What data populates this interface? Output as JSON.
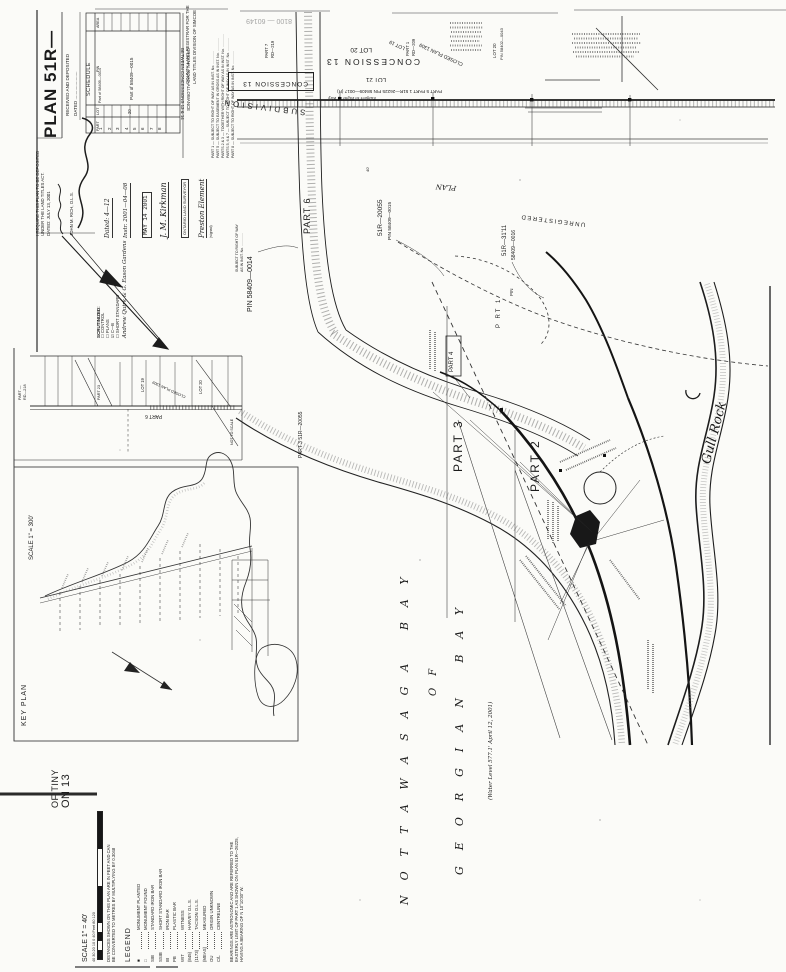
{
  "title_block": {
    "plan_no": "PLAN 51R—",
    "received": "RECEIVED AND DEPOSITED",
    "dated_blank": "DATED ......................",
    "registrar1": "COUNTY LAND REGISTRAR FOR THE",
    "registrar2": "LAND TITLES DIVISION OF SIMCOE",
    "stamp_no": "8100 — 60149",
    "require1": "I REQUIRE THIS PLAN TO BE DEPOSITED",
    "require2": "UNDER THE LAND TITLES ACT.",
    "require_dated": "DATED: JULY 13, 2001",
    "require_signed": "JOHN M. RICH,  O.L.S."
  },
  "schedule": {
    "title": "SCHEDULE",
    "col_part": "PART",
    "col_lot": "LOT",
    "col_pin": "PIN",
    "col_area": "AREA",
    "rows": [
      "1",
      "2",
      "3",
      "4",
      "5",
      "6",
      "7",
      "8"
    ],
    "pin_row1": "Part of 58409—0014",
    "pin_merged": "Part of 58409—0015",
    "lot_value": "20"
  },
  "notes": {
    "n1": "PART 1 — SUBJECT TO RIGHT OF WAY AS IN INST. No. .............",
    "n2": "PART 5 — SUBJECT TO EASEMENT IN GROSS AS IN INST. No. .............",
    "n3": "PARTS 2 & 3 — TOGETHER WITH RIGHT OF WAY AS IN INST. No. .............",
    "n4": "PARTS 5, 6 & 7 — SUBJECT TO RIGHT OF WAY AS IN INST. No. .............",
    "n5": "PART 8 — SUBJECT TO RIGHT OF WAY AS IN INST. No. ............."
  },
  "certificate": {
    "dated_hand": "Dated: 4—12",
    "instr_hand": "Instr. 2001—04—08",
    "date_stamp": "MAY 14 2001",
    "sig1": "J. M. Kirkman",
    "role_box": "ONTARIO LAND SURVEYOR",
    "sig2": "Preston Element",
    "signed_note": "(signed)",
    "firm": "Andrew Quirk & G. Eason Gardens"
  },
  "checklist": {
    "title": "SCRUTINIZED:",
    "i1": "☐ CONTROL",
    "i2": "☐ PLANS",
    "i3": "☑ C—B",
    "i4": "☐ SHORT STANDARD"
  },
  "road": {
    "allowance1": "ORIGINAL ROAD ALLOWANCE",
    "allowance2": "BETWEEN CONCESSIONS 13 & 14",
    "concession_a": "CONCESSION 13",
    "concession_b": "CONCESSION 13",
    "strip_note": "PART 5    PART 1  51R—26225   PIN 58409—0017 (R)",
    "strip_note2": "Subject to Right of Way",
    "subdivision": "SUBDIVISION"
  },
  "lots": {
    "lot20": "LOT 20",
    "lot21": "LOT 21",
    "lot19": "LOT 19",
    "lot20b": "LOT 20",
    "pin58402": "PIN 58402—0043",
    "part1": "PART 1",
    "rd209": "RD—209",
    "part7": "PART 7",
    "rd219": "RD—219",
    "closed_plan": "CLOSED PLAN 1309"
  },
  "parts": {
    "part6": "PART 6",
    "pin0014": "PIN  58409—0014",
    "row1": "SUBJECT TO RIGHT OF WAY",
    "row2": "AS IN INST. No. .............",
    "part3_51r": "PART 3  51R—20055",
    "r20055": "51R—20055",
    "pin0015": "PIN 58409—0015",
    "plan_word": "PLAN",
    "unregistered": "UNREGISTERED",
    "r3111": "51R—31'11",
    "pin0016": "58409—0016",
    "part1v": "P RT 1",
    "pin_word": "PIN",
    "part4": "PART 4",
    "part3": "PART 3",
    "part2": "PART 2",
    "width40": "40'"
  },
  "water": {
    "bay1": "NOTTAWASAGA  BAY",
    "of_word": "OF",
    "bay2": "GEORGIAN  BAY",
    "level": "(Water Level 577.1'  April 12, 2001)",
    "gull_rock": "Gull Rock"
  },
  "strip_inset": {
    "l1": "PART —",
    "l2": "RD—218",
    "part23": "PART 23",
    "lot19": "LOT 19",
    "closed": "CLOSED PLAN 1309",
    "lot20": "LOT 20",
    "part6": "PART 6",
    "nts": "NOT TO SCALE"
  },
  "key_plan": {
    "title": "KEY PLAN",
    "scale": "SCALE  1\" = 300'"
  },
  "sheet_title": {
    "line1": "OF TINY",
    "line2": "ON 13"
  },
  "scale_block": {
    "scale": "SCALE   1\" = 40'",
    "bar_numbers": "40   30   20   10    0              40 Feet               80              120",
    "note1": "DISTANCES SHOWN ON THIS PLAN ARE IN FEET AND CAN",
    "note2": "BE CONVERTED TO METRES BY MULTIPLYING BY 0.3048",
    "legend_title": "LEGEND",
    "items": [
      {
        "sym": "■",
        "desc": "MONUMENT PLANTED"
      },
      {
        "sym": "□",
        "desc": "MONUMENT FOUND"
      },
      {
        "sym": "SIB",
        "desc": "STANDARD IRON BAR"
      },
      {
        "sym": "SSIB",
        "desc": "SHORT STANDARD IRON BAR"
      },
      {
        "sym": "IB",
        "desc": "IRON BAR"
      },
      {
        "sym": "PB",
        "desc": "PLASTIC BAR"
      },
      {
        "sym": "WIT",
        "desc": "WITNESS"
      },
      {
        "sym": "(845)",
        "desc": "HARVEY  O.L.S."
      },
      {
        "sym": "(1173)",
        "desc": "TACSON  O.L.S."
      },
      {
        "sym": "(MEAS)",
        "desc": "MEASURED"
      },
      {
        "sym": "OU",
        "desc": "ORIGIN UNKNOWN"
      },
      {
        "sym": "C/L",
        "desc": "CENTRELINE"
      }
    ],
    "bearings1": "BEARINGS ARE ASTRONOMIC AND ARE REFERRED TO THE",
    "bearings2": "EASTERLY LIMIT OF PART 1 AS SHOWN ON PLAN 51R—26225,",
    "bearings3": "HAVING A BEARING OF N 10°10'30\" W."
  }
}
